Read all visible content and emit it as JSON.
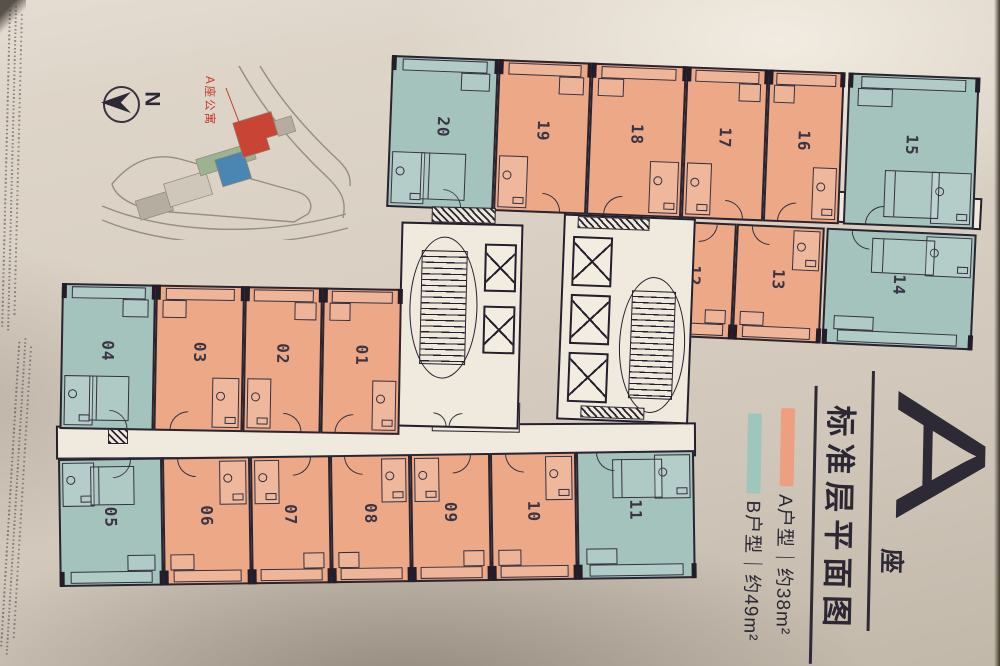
{
  "plan": {
    "units": [
      {
        "label": "01",
        "type": "A"
      },
      {
        "label": "02",
        "type": "A"
      },
      {
        "label": "03",
        "type": "A"
      },
      {
        "label": "04",
        "type": "B"
      },
      {
        "label": "05",
        "type": "B"
      },
      {
        "label": "06",
        "type": "A"
      },
      {
        "label": "07",
        "type": "A"
      },
      {
        "label": "08",
        "type": "A"
      },
      {
        "label": "09",
        "type": "A"
      },
      {
        "label": "10",
        "type": "A"
      },
      {
        "label": "11",
        "type": "B"
      },
      {
        "label": "12",
        "type": "A"
      },
      {
        "label": "13",
        "type": "A"
      },
      {
        "label": "14",
        "type": "B"
      },
      {
        "label": "15",
        "type": "B"
      },
      {
        "label": "16",
        "type": "A"
      },
      {
        "label": "17",
        "type": "A"
      },
      {
        "label": "18",
        "type": "A"
      },
      {
        "label": "19",
        "type": "A"
      },
      {
        "label": "20",
        "type": "B"
      }
    ]
  },
  "legend": {
    "building_letter": "A",
    "building_suffix": "座",
    "title": "标准层平面图",
    "items": [
      {
        "label": "A户型｜约38m²",
        "swatch_color": "#eda081"
      },
      {
        "label": "B户型｜约49m²",
        "swatch_color": "#9fc6bd"
      }
    ]
  },
  "compass": {
    "north_label": "N"
  },
  "site_map": {
    "highlight_label": "A座公寓",
    "highlight_color": "#c94434"
  },
  "colors": {
    "unit_type_a_fill": "#eca887",
    "unit_type_b_fill": "#a4c3bd",
    "plan_line": "#29242f",
    "paper": "#d8cfc3",
    "legend_text": "#2c2833",
    "site_label_red": "#c23b2c"
  }
}
